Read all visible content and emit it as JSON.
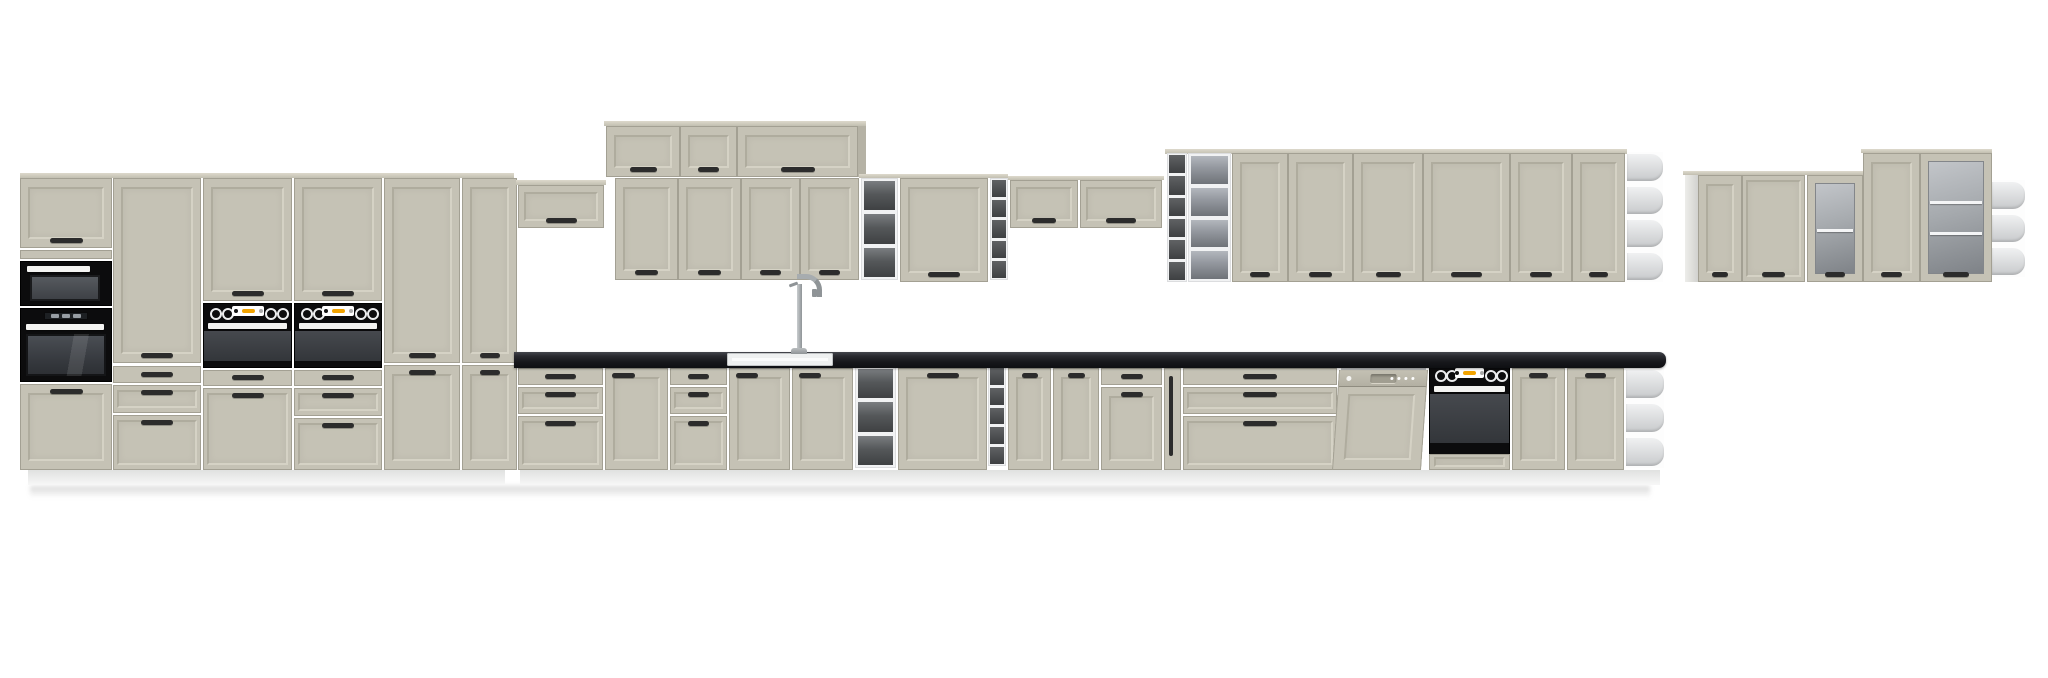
{
  "canvas": {
    "w": 2048,
    "h": 678
  },
  "colors": {
    "face": "#c5c2b5",
    "faceLine": "#a3a093",
    "panelDark": "#afac9e",
    "panelLight": "#d5d2c5",
    "handle": "#2c2c2c",
    "topFace": "#ddd9cc",
    "topFaceDark": "#c2bfb1",
    "sideDark": "#b5b2a5",
    "shelfFrame": "#f1f2f3",
    "compDark": "#55585a",
    "compDarker": "#3f4143",
    "compMid": "#9599a0",
    "compMidDark": "#6f7378",
    "counterTop": "#44464c",
    "counterFace": "#17181c",
    "plinthTop": "#e0e1e0",
    "plinthBottom": "#f7f7f7",
    "applianceBlack": "#0c0c0d",
    "ovenDoorTop": "#46494e",
    "ovenDoorBottom": "#33363a",
    "whiteBar": "#f4f4f2",
    "amber": "#f2a300",
    "displayWhite": "#ffffff",
    "sinkWhite": "#fafbfb",
    "glassTop": "#c3c6ca",
    "glassBottom": "#7e8287"
  },
  "scene": {
    "modules": [
      {
        "k": "shadow",
        "n": "floor-shadow",
        "x": 30,
        "y": 486,
        "w": 1620,
        "h": 12
      },
      {
        "k": "plinth",
        "n": "plinth-tall-run",
        "x": 28,
        "y": 470,
        "w": 477,
        "h": 15
      },
      {
        "k": "plinth",
        "n": "plinth-base-run",
        "x": 520,
        "y": 470,
        "w": 1140,
        "h": 15
      },
      {
        "k": "top",
        "n": "top-edge-tall-run",
        "x": 20,
        "y": 173,
        "w": 494,
        "h": 5
      },
      {
        "k": "door",
        "n": "oven-tower-upper-door",
        "x": 20,
        "y": 178,
        "w": 92,
        "h": 70,
        "hp": "bc"
      },
      {
        "k": "slab",
        "n": "oven-tower-filler",
        "x": 20,
        "y": 250,
        "w": 92,
        "h": 9,
        "hp": "n"
      },
      {
        "k": "mw",
        "n": "built-in-microwave",
        "x": 20,
        "y": 261,
        "w": 92,
        "h": 45
      },
      {
        "k": "oven1",
        "n": "built-in-single-oven",
        "x": 20,
        "y": 308,
        "w": 92,
        "h": 74
      },
      {
        "k": "door",
        "n": "oven-tower-lower-door",
        "x": 20,
        "y": 384,
        "w": 92,
        "h": 86,
        "hp": "tc"
      },
      {
        "k": "door",
        "n": "tall-larder-door",
        "x": 113,
        "y": 178,
        "w": 88,
        "h": 185,
        "hp": "bc"
      },
      {
        "k": "slab",
        "n": "drawer-front",
        "x": 113,
        "y": 366,
        "w": 88,
        "h": 17,
        "hp": "c"
      },
      {
        "k": "fdrawer",
        "n": "drawer-front",
        "x": 113,
        "y": 385,
        "w": 88,
        "h": 28
      },
      {
        "k": "fdrawer",
        "n": "drawer-front",
        "x": 113,
        "y": 415,
        "w": 88,
        "h": 55
      },
      {
        "k": "door",
        "n": "oven-tower-upper-door",
        "x": 203,
        "y": 178,
        "w": 89,
        "h": 123,
        "hp": "bc"
      },
      {
        "k": "toven",
        "n": "built-in-oven",
        "x": 203,
        "y": 303,
        "w": 89,
        "h": 65
      },
      {
        "k": "slab",
        "n": "drawer-front",
        "x": 203,
        "y": 370,
        "w": 89,
        "h": 16,
        "hp": "c"
      },
      {
        "k": "fdrawer",
        "n": "drawer-front",
        "x": 203,
        "y": 388,
        "w": 89,
        "h": 82
      },
      {
        "k": "door",
        "n": "oven-tower-upper-door",
        "x": 294,
        "y": 178,
        "w": 88,
        "h": 123,
        "hp": "bc"
      },
      {
        "k": "toven",
        "n": "built-in-oven",
        "x": 294,
        "y": 303,
        "w": 88,
        "h": 65
      },
      {
        "k": "slab",
        "n": "drawer-front",
        "x": 294,
        "y": 370,
        "w": 88,
        "h": 16,
        "hp": "c"
      },
      {
        "k": "fdrawer",
        "n": "drawer-front",
        "x": 294,
        "y": 388,
        "w": 88,
        "h": 28
      },
      {
        "k": "fdrawer",
        "n": "drawer-front",
        "x": 294,
        "y": 418,
        "w": 88,
        "h": 52
      },
      {
        "k": "door",
        "n": "tall-cabinet-upper-door",
        "x": 384,
        "y": 178,
        "w": 76,
        "h": 185,
        "hp": "bc"
      },
      {
        "k": "door",
        "n": "tall-cabinet-lower-door",
        "x": 384,
        "y": 365,
        "w": 76,
        "h": 105,
        "hp": "tc"
      },
      {
        "k": "door",
        "n": "tall-cabinet-upper-door",
        "x": 462,
        "y": 178,
        "w": 55,
        "h": 185,
        "hp": "bc"
      },
      {
        "k": "door",
        "n": "tall-cabinet-lower-door",
        "x": 462,
        "y": 365,
        "w": 55,
        "h": 105,
        "hp": "tc"
      },
      {
        "k": "top",
        "n": "top-edge-box-cabinet",
        "x": 516,
        "y": 180,
        "w": 90,
        "h": 5
      },
      {
        "k": "door",
        "n": "over-counter-wall-box",
        "x": 518,
        "y": 185,
        "w": 86,
        "h": 43,
        "hp": "bc"
      },
      {
        "k": "top",
        "n": "top-edge-upper-row",
        "x": 604,
        "y": 121,
        "w": 262,
        "h": 5
      },
      {
        "k": "door",
        "n": "top-row-wall-cabinet",
        "x": 606,
        "y": 126,
        "w": 74,
        "h": 51,
        "hp": "bc"
      },
      {
        "k": "door",
        "n": "top-row-wall-cabinet",
        "x": 680,
        "y": 126,
        "w": 57,
        "h": 51,
        "hp": "bc"
      },
      {
        "k": "door",
        "n": "top-row-wall-cabinet-wide",
        "x": 737,
        "y": 126,
        "w": 121,
        "h": 51,
        "hp": "bc"
      },
      {
        "k": "side",
        "n": "top-row-side-panel",
        "x": 858,
        "y": 126,
        "w": 8,
        "h": 51
      },
      {
        "k": "door",
        "n": "wall-cabinet-door",
        "x": 615,
        "y": 178,
        "w": 63,
        "h": 102,
        "hp": "bc"
      },
      {
        "k": "door",
        "n": "wall-cabinet-door",
        "x": 678,
        "y": 178,
        "w": 63,
        "h": 102,
        "hp": "bc"
      },
      {
        "k": "door",
        "n": "wall-cabinet-door",
        "x": 741,
        "y": 178,
        "w": 59,
        "h": 102,
        "hp": "bc"
      },
      {
        "k": "door",
        "n": "wall-cabinet-door",
        "x": 800,
        "y": 178,
        "w": 59,
        "h": 102,
        "hp": "bc"
      },
      {
        "k": "top",
        "n": "top-edge-wall-shelf",
        "x": 859,
        "y": 174,
        "w": 149,
        "h": 4
      },
      {
        "k": "shelf",
        "n": "wall-open-shelf",
        "x": 861,
        "y": 178,
        "w": 37,
        "h": 102,
        "rows": 3,
        "tone": "dark"
      },
      {
        "k": "door",
        "n": "wall-cabinet-door",
        "x": 900,
        "y": 178,
        "w": 88,
        "h": 104,
        "hp": "bc"
      },
      {
        "k": "rack",
        "n": "wall-wine-rack",
        "x": 990,
        "y": 178,
        "w": 18,
        "h": 102,
        "rows": 5
      },
      {
        "k": "top",
        "n": "top-edge-short-cabinets",
        "x": 1008,
        "y": 176,
        "w": 156,
        "h": 4
      },
      {
        "k": "door",
        "n": "short-wall-cabinet",
        "x": 1010,
        "y": 180,
        "w": 68,
        "h": 48,
        "hp": "bc"
      },
      {
        "k": "door",
        "n": "short-wall-cabinet",
        "x": 1080,
        "y": 180,
        "w": 82,
        "h": 48,
        "hp": "bc"
      },
      {
        "k": "top",
        "n": "top-edge-right-wall-run",
        "x": 1165,
        "y": 149,
        "w": 462,
        "h": 5
      },
      {
        "k": "rack",
        "n": "wall-wine-rack",
        "x": 1167,
        "y": 153,
        "w": 20,
        "h": 129,
        "rows": 6
      },
      {
        "k": "shelf",
        "n": "wall-shelf-column",
        "x": 1188,
        "y": 153,
        "w": 43,
        "h": 129,
        "rows": 4,
        "tone": "mid"
      },
      {
        "k": "door",
        "n": "wall-cabinet-door",
        "x": 1232,
        "y": 153,
        "w": 56,
        "h": 129,
        "hp": "bc"
      },
      {
        "k": "door",
        "n": "wall-cabinet-door",
        "x": 1288,
        "y": 153,
        "w": 65,
        "h": 129,
        "hp": "bc"
      },
      {
        "k": "door",
        "n": "wall-cabinet-door",
        "x": 1353,
        "y": 153,
        "w": 70,
        "h": 129,
        "hp": "bc"
      },
      {
        "k": "door",
        "n": "wall-cabinet-door",
        "x": 1423,
        "y": 153,
        "w": 87,
        "h": 129,
        "hp": "bc"
      },
      {
        "k": "door",
        "n": "wall-cabinet-door",
        "x": 1510,
        "y": 153,
        "w": 62,
        "h": 129,
        "hp": "bc"
      },
      {
        "k": "door",
        "n": "wall-cabinet-door",
        "x": 1572,
        "y": 153,
        "w": 53,
        "h": 129,
        "hp": "bc"
      },
      {
        "k": "end",
        "n": "wall-end-open-shelf",
        "x": 1627,
        "y": 152,
        "w": 36,
        "h": 130,
        "rows": 4
      },
      {
        "k": "top",
        "n": "top-edge-far-right-short",
        "x": 1683,
        "y": 171,
        "w": 182,
        "h": 4
      },
      {
        "k": "top",
        "n": "top-edge-far-right-tall",
        "x": 1861,
        "y": 149,
        "w": 131,
        "h": 4
      },
      {
        "k": "sidelight",
        "n": "wall-cabinet-side-panel",
        "x": 1685,
        "y": 175,
        "w": 13,
        "h": 107
      },
      {
        "k": "door",
        "n": "wall-cabinet-door",
        "x": 1698,
        "y": 175,
        "w": 44,
        "h": 107,
        "hp": "bc"
      },
      {
        "k": "door",
        "n": "wall-cabinet-slab-door",
        "x": 1742,
        "y": 175,
        "w": 63,
        "h": 107,
        "hp": "bc",
        "fi": 5
      },
      {
        "k": "glass",
        "n": "wall-glass-door-cabinet",
        "x": 1807,
        "y": 175,
        "w": 56,
        "h": 107,
        "hp": "bc",
        "sh": [
          0.5
        ]
      },
      {
        "k": "door",
        "n": "tall-wall-cabinet-door",
        "x": 1863,
        "y": 153,
        "w": 57,
        "h": 129,
        "hp": "bc"
      },
      {
        "k": "glass",
        "n": "tall-wall-glass-cabinet",
        "x": 1920,
        "y": 153,
        "w": 72,
        "h": 129,
        "hp": "bc",
        "sh": [
          0.35,
          0.63
        ]
      },
      {
        "k": "end",
        "n": "wall-end-open-shelf",
        "x": 1992,
        "y": 180,
        "w": 33,
        "h": 97,
        "rows": 3
      },
      {
        "k": "slab",
        "n": "base-drawer-front",
        "x": 518,
        "y": 368,
        "w": 85,
        "h": 17,
        "hp": "c"
      },
      {
        "k": "fdrawer",
        "n": "base-drawer-front",
        "x": 518,
        "y": 387,
        "w": 85,
        "h": 27
      },
      {
        "k": "fdrawer",
        "n": "base-drawer-front",
        "x": 518,
        "y": 416,
        "w": 85,
        "h": 54
      },
      {
        "k": "door",
        "n": "base-cabinet-door",
        "x": 605,
        "y": 368,
        "w": 63,
        "h": 102,
        "hp": "tl"
      },
      {
        "k": "slab",
        "n": "base-drawer-front",
        "x": 670,
        "y": 368,
        "w": 57,
        "h": 17,
        "hp": "c"
      },
      {
        "k": "fdrawer",
        "n": "base-drawer-front",
        "x": 670,
        "y": 387,
        "w": 57,
        "h": 27
      },
      {
        "k": "fdrawer",
        "n": "base-drawer-front",
        "x": 670,
        "y": 416,
        "w": 57,
        "h": 54
      },
      {
        "k": "door",
        "n": "sink-base-door",
        "x": 729,
        "y": 368,
        "w": 61,
        "h": 102,
        "hp": "tl"
      },
      {
        "k": "door",
        "n": "sink-base-door",
        "x": 792,
        "y": 368,
        "w": 61,
        "h": 102,
        "hp": "tl"
      },
      {
        "k": "shelf",
        "n": "base-open-shelf",
        "x": 855,
        "y": 366,
        "w": 41,
        "h": 102,
        "rows": 3,
        "tone": "dark"
      },
      {
        "k": "door",
        "n": "base-cabinet-door",
        "x": 898,
        "y": 368,
        "w": 89,
        "h": 102,
        "hp": "tc"
      },
      {
        "k": "rack",
        "n": "base-wine-rack",
        "x": 988,
        "y": 366,
        "w": 18,
        "h": 100,
        "rows": 5
      },
      {
        "k": "door",
        "n": "base-cabinet-door",
        "x": 1008,
        "y": 368,
        "w": 43,
        "h": 102,
        "hp": "tc"
      },
      {
        "k": "door",
        "n": "base-cabinet-door",
        "x": 1053,
        "y": 368,
        "w": 46,
        "h": 102,
        "hp": "tc"
      },
      {
        "k": "slab",
        "n": "base-drawer-front",
        "x": 1101,
        "y": 368,
        "w": 61,
        "h": 17,
        "hp": "c"
      },
      {
        "k": "door",
        "n": "base-cabinet-door",
        "x": 1101,
        "y": 387,
        "w": 61,
        "h": 83,
        "hp": "tc"
      },
      {
        "k": "pull",
        "n": "base-pullout-unit",
        "x": 1164,
        "y": 368,
        "w": 17,
        "h": 102
      },
      {
        "k": "slab",
        "n": "base-drawer-front",
        "x": 1183,
        "y": 368,
        "w": 154,
        "h": 17,
        "hp": "c"
      },
      {
        "k": "fdrawer",
        "n": "base-drawer-front",
        "x": 1183,
        "y": 387,
        "w": 154,
        "h": 27
      },
      {
        "k": "fdrawer",
        "n": "base-drawer-front",
        "x": 1183,
        "y": 416,
        "w": 154,
        "h": 54
      },
      {
        "k": "dw",
        "n": "dishwasher",
        "x": 1339,
        "y": 363,
        "w": 89,
        "h": 107
      },
      {
        "k": "boven",
        "n": "built-under-oven",
        "x": 1429,
        "y": 365,
        "w": 81,
        "h": 105
      },
      {
        "k": "door",
        "n": "base-cabinet-door",
        "x": 1512,
        "y": 368,
        "w": 53,
        "h": 102,
        "hp": "tc"
      },
      {
        "k": "door",
        "n": "base-cabinet-door",
        "x": 1567,
        "y": 368,
        "w": 57,
        "h": 102,
        "hp": "tc"
      },
      {
        "k": "end",
        "n": "base-end-open-shelf",
        "x": 1626,
        "y": 368,
        "w": 38,
        "h": 100,
        "rows": 3
      },
      {
        "k": "counter",
        "n": "worktop",
        "x": 514,
        "y": 352,
        "w": 1152,
        "h": 16
      },
      {
        "k": "sink",
        "n": "inset-sink",
        "x": 727,
        "y": 353,
        "w": 106,
        "h": 13
      },
      {
        "k": "faucet",
        "n": "sink-faucet",
        "x": 788,
        "y": 274,
        "w": 36,
        "h": 80
      }
    ]
  }
}
